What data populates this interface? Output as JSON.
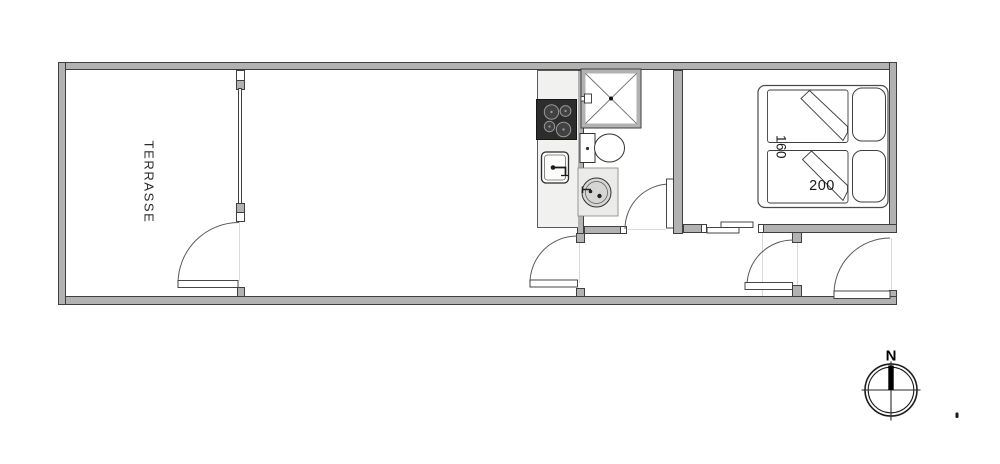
{
  "plan": {
    "rooms": {
      "terrace_label": "TERRASSE"
    },
    "bedroom": {
      "bed_width_label": "160",
      "bed_length_label": "200"
    },
    "compass": {
      "north_label": "N"
    }
  },
  "colors": {
    "background": "#ffffff",
    "wall_fill": "#b2b2b2",
    "wall_outline": "#3f3f3f",
    "counter_fill": "#f1f1ef",
    "stove_fill": "#2d2d2d",
    "basin_fill": "#d6d6d5",
    "line": "#333333"
  }
}
